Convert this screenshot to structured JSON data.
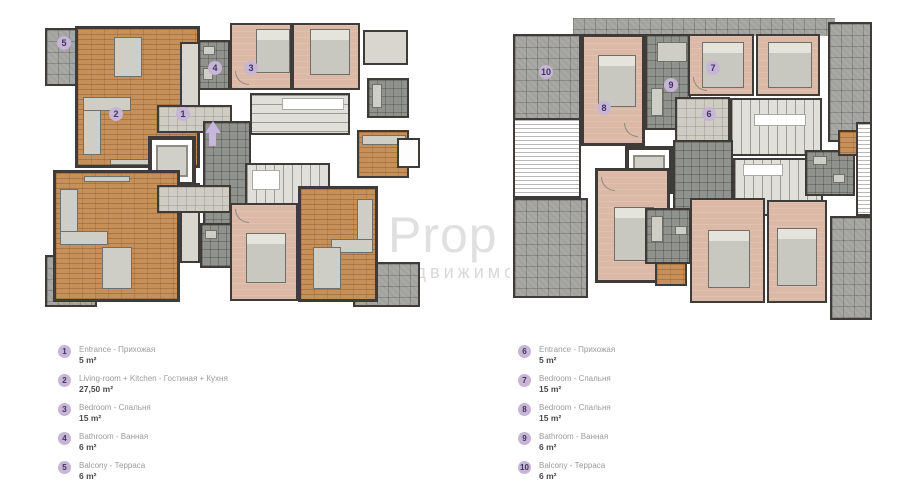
{
  "watermark": {
    "line1": "Prop",
    "line2": "недвижимос"
  },
  "plans": {
    "left": {
      "badges": [
        "1",
        "2",
        "3",
        "4",
        "5"
      ]
    },
    "right": {
      "badges": [
        "6",
        "7",
        "8",
        "9",
        "10"
      ]
    }
  },
  "legend_left": {
    "items": [
      {
        "num": "1",
        "label": "Entrance - Прихожая",
        "area": "5 m²"
      },
      {
        "num": "2",
        "label": "Living-room + Kitchen - Гостиная + Кухня",
        "area": "27,50 m²"
      },
      {
        "num": "3",
        "label": "Bedroom - Спальня",
        "area": "15 m²"
      },
      {
        "num": "4",
        "label": "Bathroom - Ванная",
        "area": "6 m²"
      },
      {
        "num": "5",
        "label": "Balcony - Терраса",
        "area": "6 m²"
      }
    ]
  },
  "legend_right": {
    "items": [
      {
        "num": "6",
        "label": "Entrance - Прихожая",
        "area": "5 m²"
      },
      {
        "num": "7",
        "label": "Bedroom - Спальня",
        "area": "15 m²"
      },
      {
        "num": "8",
        "label": "Bedroom - Спальня",
        "area": "15 m²"
      },
      {
        "num": "9",
        "label": "Bathroom - Ванная",
        "area": "6 m²"
      },
      {
        "num": "10",
        "label": "Balcony - Терраса",
        "area": "6 m²"
      }
    ]
  },
  "colors": {
    "wall": "#3e3b39",
    "wood_floor": "#c5905a",
    "bedroom_floor": "#dcb9a7",
    "balcony_tile": "#a2a29e",
    "badge": "#c6b5d4",
    "arrow": "#c9b6dd",
    "watermark": "#e0e0e0"
  }
}
